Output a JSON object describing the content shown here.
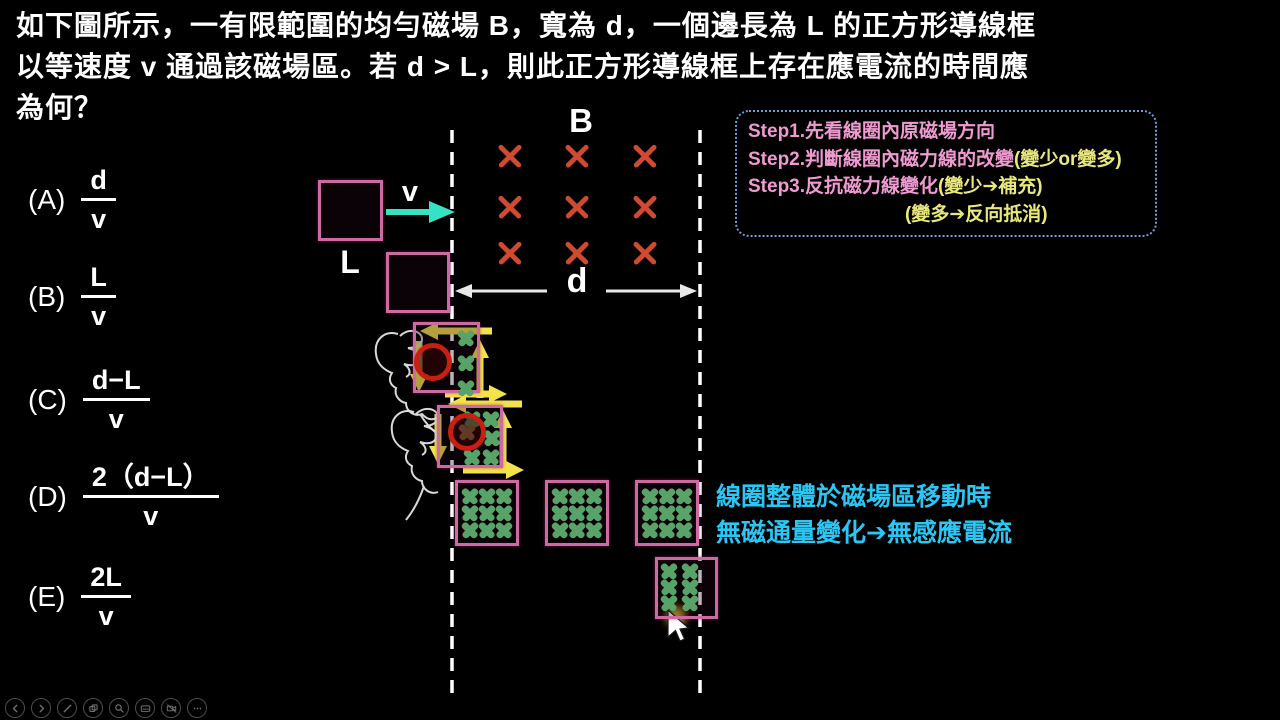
{
  "title": {
    "line1": "如下圖所示，一有限範圍的均勻磁場 B，寬為 d，一個邊長為 L 的正方形導線框",
    "line2": "以等速度 v 通過該磁場區。若 d > L，則此正方形導線框上存在應電流的時間應",
    "line3": "為何？"
  },
  "options": [
    {
      "label": "(A)",
      "numerator": "d",
      "denominator": "v"
    },
    {
      "label": "(B)",
      "numerator": "L",
      "denominator": "v"
    },
    {
      "label": "(C)",
      "numerator": "d−L",
      "denominator": "v"
    },
    {
      "label": "(D)",
      "numerator": "2（d−L）",
      "denominator": "v"
    },
    {
      "label": "(E)",
      "numerator": "2L",
      "denominator": "v"
    }
  ],
  "diagram": {
    "field_label": "B",
    "field_width_label": "d",
    "velocity_label": "v",
    "loop_side_label": "L"
  },
  "steps_box": {
    "step1": "Step1.先看線圈內原磁場方向",
    "step2_main": "Step2.判斷線圈內磁力線的改變",
    "step2_paren": "(變少or變多)",
    "step3_main": "Step3.反抗磁力線變化",
    "step3_paren": "(變少➔補充)",
    "step3_paren2": "(變多➔反向抵消)"
  },
  "note": {
    "line1": "線圈整體於磁場區移動時",
    "line2": "無磁通量變化➔無感應電流"
  },
  "toolbar": {
    "icons": [
      {
        "name": "back"
      },
      {
        "name": "forward"
      },
      {
        "name": "pen"
      },
      {
        "name": "copy"
      },
      {
        "name": "zoom"
      },
      {
        "name": "subtitles"
      },
      {
        "name": "video-off"
      },
      {
        "name": "more"
      }
    ]
  },
  "colors": {
    "background": "#000000",
    "loop_pink": "#cd6aa2",
    "field_cross_red": "#cf4a30",
    "flux_cross_green": "#58a468",
    "arrow_yellow": "#f3e24c",
    "velocity_cyan": "#35e2c4",
    "note_cyan": "#2cc5f4",
    "step_pink": "#f09ad2",
    "step_yellow": "#e9e87e",
    "box_border_blue": "#6b9fe0",
    "ring_red": "#c81f12"
  }
}
